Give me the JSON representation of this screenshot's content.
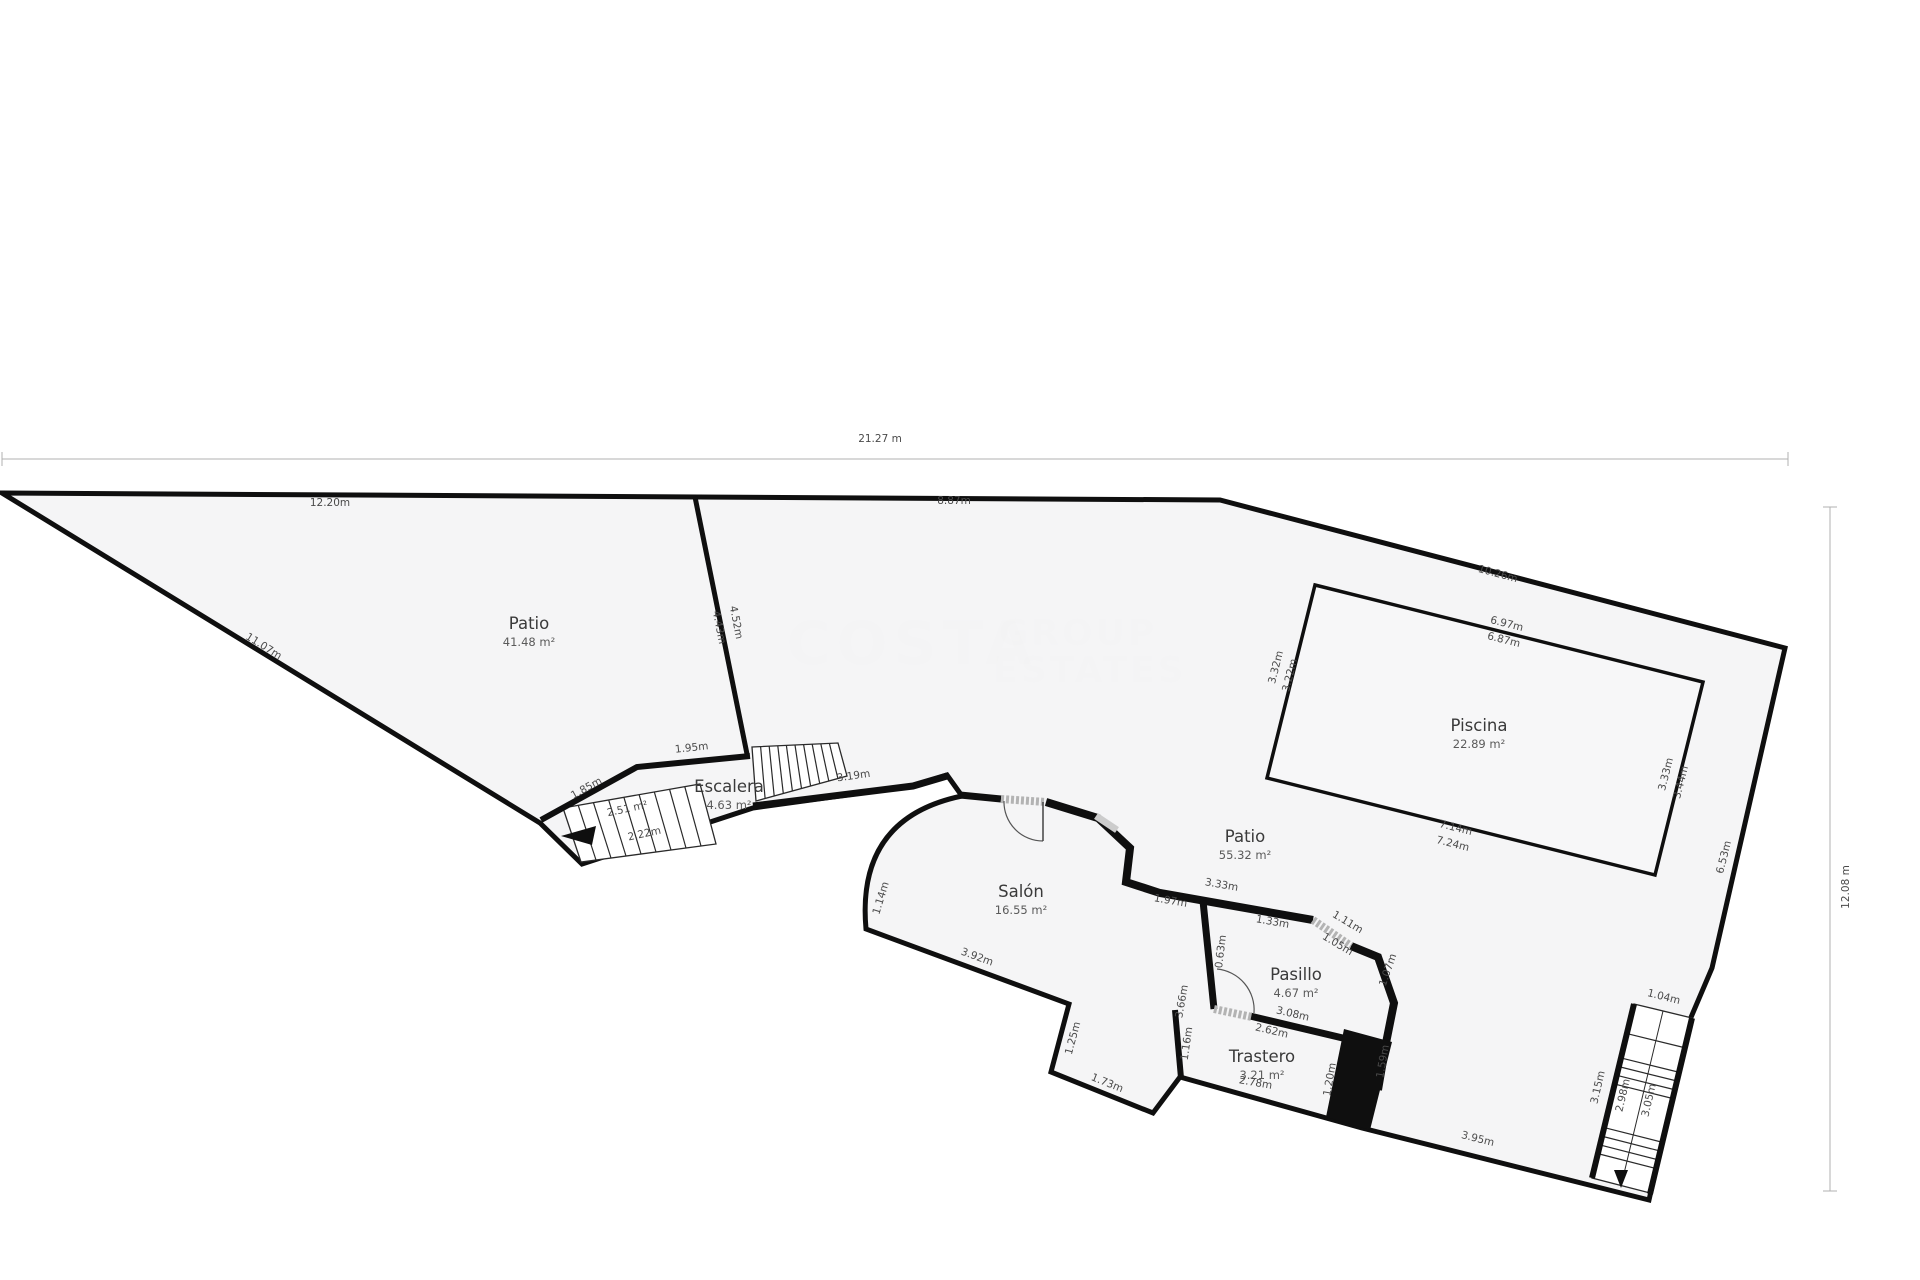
{
  "title": "Plano de planta",
  "colors": {
    "plot_fill": "#f4f4f5",
    "pool_fill": "#f7f7f8",
    "wall": "#0f0f0f",
    "thin": "#2a2a2a",
    "dim_line": "#b0b0b0",
    "dim_text": "#4a4a4a",
    "room_text": "#3a3a3a",
    "door": "#b3b3b3"
  },
  "plan": {
    "outline": "M 2,493 L 1220,500 L 1785,648 L 1712,968 L 1689,1022 L 1649,1200 L 1362,1128 L 1180,1077 L 1153,1113 L 1051,1072 L 1069,1004 L 866,929 Q 856,818 962,796 L 947,775 L 913,786 L 753,808 L 582,864 L 540,823 Z",
    "pool": "M 1315,585 L 1703,682 L 1655,875 L 1267,778 Z",
    "block": "M 1344,1029 L 1392,1042 L 1370,1130 L 1326,1117 Z",
    "walls": [
      {
        "d": "M 695,497 L 747,754",
        "w": 5
      },
      {
        "d": "M 541,820 L 637,767 L 750,756",
        "w": 6
      },
      {
        "d": "M 753,806 L 913,786 L 947,776",
        "w": 7
      },
      {
        "d": "M 960,795 L 1001,799",
        "w": 7
      },
      {
        "d": "M 1046,802 L 1098,818 L 1130,848 L 1126,882 L 1160,893 L 1313,920",
        "w": 8
      },
      {
        "d": "M 1351,946 L 1378,957 L 1394,1003 L 1386,1043 L 1378,1090",
        "w": 8
      },
      {
        "d": "M 1203,901 L 1214,1009",
        "w": 7
      },
      {
        "d": "M 1250,1016 L 1368,1044",
        "w": 7
      },
      {
        "d": "M 1175,1010 L 1181,1078",
        "w": 6
      },
      {
        "d": "M 1634,1004 L 1592,1178",
        "w": 6
      },
      {
        "d": "M 1692,1018 L 1650,1194",
        "w": 6
      }
    ],
    "windows": [
      {
        "d": "M 1096,816 L 1117,830",
        "w": 7
      }
    ],
    "doors": [
      {
        "leaf": "M 1001,799 L 1046,802",
        "arc": "M 1004,801 A 39,39 0 0 0 1043,841",
        "pivot": "M 1043,802 L 1043,841"
      },
      {
        "leaf": "M 1313,920 L 1351,946",
        "arc": "",
        "pivot": ""
      },
      {
        "leaf": "M 1214,1009 L 1252,1017",
        "arc": "M 1217,969 A 41,41 0 0 1 1254,1013",
        "pivot": ""
      }
    ],
    "stairs": [
      {
        "corners": [
          [
            563,
            808
          ],
          [
            700,
            784
          ],
          [
            716,
            844
          ],
          [
            581,
            862
          ]
        ],
        "treads": 8,
        "dir": "h",
        "axis": false
      },
      {
        "corners": [
          [
            752,
            747
          ],
          [
            838,
            743
          ],
          [
            847,
            776
          ],
          [
            756,
            801
          ]
        ],
        "treads": 9,
        "dir": "h",
        "axis": false
      },
      {
        "corners": [
          [
            1634,
            1004
          ],
          [
            1692,
            1018
          ],
          [
            1650,
            1193
          ],
          [
            1592,
            1178
          ]
        ],
        "treads": [
          0.17,
          0.31,
          0.36,
          0.41,
          0.46,
          0.71,
          0.76,
          0.81,
          0.86
        ],
        "dir": "v",
        "axis": true
      }
    ],
    "axis_line": "M 1663,1011 L 1621,1186",
    "arrows": [
      [
        [
          561,
          836
        ],
        [
          596,
          826
        ],
        [
          592,
          845
        ]
      ],
      [
        [
          1614,
          1170
        ],
        [
          1628,
          1170
        ],
        [
          1621,
          1188
        ]
      ]
    ],
    "dim_lines": [
      {
        "d": "M 2,459 L 1788,459"
      },
      {
        "d": "M 2,452 L 2,466"
      },
      {
        "d": "M 1788,452 L 1788,466"
      },
      {
        "d": "M 1830,507 L 1830,1191"
      },
      {
        "d": "M 1823,507 L 1837,507"
      },
      {
        "d": "M 1823,1191 L 1837,1191"
      }
    ],
    "rooms": [
      {
        "name": "Patio",
        "area": "41.48 m²",
        "x": 529,
        "y": 629
      },
      {
        "name": "Patio",
        "area": "55.32 m²",
        "x": 1245,
        "y": 842
      },
      {
        "name": "Piscina",
        "area": "22.89 m²",
        "x": 1479,
        "y": 731
      },
      {
        "name": "Salón",
        "area": "16.55 m²",
        "x": 1021,
        "y": 897
      },
      {
        "name": "Pasillo",
        "area": "4.67 m²",
        "x": 1296,
        "y": 980
      },
      {
        "name": "Trastero",
        "area": "3.21 m²",
        "x": 1262,
        "y": 1062
      },
      {
        "name": "Escalera",
        "area": "4.63 m²",
        "x": 729,
        "y": 792
      }
    ],
    "dims": [
      {
        "t": "21.27 m",
        "x": 880,
        "y": 442,
        "r": 0
      },
      {
        "t": "12.08 m",
        "x": 1849,
        "y": 887,
        "r": -90
      },
      {
        "t": "12.20m",
        "x": 330,
        "y": 506,
        "r": 0
      },
      {
        "t": "8.87m",
        "x": 954,
        "y": 504,
        "r": 0
      },
      {
        "t": "11.07m",
        "x": 262,
        "y": 649,
        "r": 32
      },
      {
        "t": "10.26m",
        "x": 1497,
        "y": 577,
        "r": 15
      },
      {
        "t": "6.97m",
        "x": 1506,
        "y": 627,
        "r": 14
      },
      {
        "t": "6.87m",
        "x": 1503,
        "y": 643,
        "r": 14
      },
      {
        "t": "3.32m",
        "x": 1279,
        "y": 668,
        "r": -76
      },
      {
        "t": "3.22m",
        "x": 1293,
        "y": 676,
        "r": -76
      },
      {
        "t": "7.14m",
        "x": 1455,
        "y": 831,
        "r": 14
      },
      {
        "t": "7.24m",
        "x": 1452,
        "y": 847,
        "r": 14
      },
      {
        "t": "3.33m",
        "x": 1669,
        "y": 775,
        "r": -76
      },
      {
        "t": "3.44m",
        "x": 1684,
        "y": 783,
        "r": -76
      },
      {
        "t": "6.53m",
        "x": 1727,
        "y": 858,
        "r": -76
      },
      {
        "t": "4.52m",
        "x": 733,
        "y": 623,
        "r": 79
      },
      {
        "t": "4.43m",
        "x": 716,
        "y": 628,
        "r": 79
      },
      {
        "t": "1.95m",
        "x": 692,
        "y": 751,
        "r": -6
      },
      {
        "t": "1.85m",
        "x": 588,
        "y": 791,
        "r": -29
      },
      {
        "t": "3.19m",
        "x": 854,
        "y": 779,
        "r": -8
      },
      {
        "t": "2.51 m²",
        "x": 628,
        "y": 812,
        "r": -12
      },
      {
        "t": "2.22m",
        "x": 645,
        "y": 837,
        "r": -12
      },
      {
        "t": "1.14m",
        "x": 884,
        "y": 899,
        "r": -73
      },
      {
        "t": "3.92m",
        "x": 976,
        "y": 960,
        "r": 20
      },
      {
        "t": "1.25m",
        "x": 1076,
        "y": 1039,
        "r": -75
      },
      {
        "t": "1.73m",
        "x": 1106,
        "y": 1086,
        "r": 22
      },
      {
        "t": "1.16m",
        "x": 1190,
        "y": 1044,
        "r": -82
      },
      {
        "t": "3.66m",
        "x": 1185,
        "y": 1002,
        "r": -80
      },
      {
        "t": "0.63m",
        "x": 1224,
        "y": 952,
        "r": -83
      },
      {
        "t": "1.97m",
        "x": 1170,
        "y": 904,
        "r": 10
      },
      {
        "t": "3.33m",
        "x": 1221,
        "y": 888,
        "r": 10
      },
      {
        "t": "1.33m",
        "x": 1272,
        "y": 925,
        "r": 10
      },
      {
        "t": "1.11m",
        "x": 1346,
        "y": 925,
        "r": 31
      },
      {
        "t": "1.05m",
        "x": 1336,
        "y": 947,
        "r": 31
      },
      {
        "t": "1.07m",
        "x": 1391,
        "y": 971,
        "r": -71
      },
      {
        "t": "1.59m",
        "x": 1386,
        "y": 1062,
        "r": -80
      },
      {
        "t": "3.08m",
        "x": 1292,
        "y": 1017,
        "r": 13
      },
      {
        "t": "2.62m",
        "x": 1271,
        "y": 1034,
        "r": 13
      },
      {
        "t": "2.78m",
        "x": 1255,
        "y": 1086,
        "r": 10
      },
      {
        "t": "1.20m",
        "x": 1333,
        "y": 1080,
        "r": -80
      },
      {
        "t": "3.95m",
        "x": 1477,
        "y": 1142,
        "r": 14
      },
      {
        "t": "1.04m",
        "x": 1663,
        "y": 1000,
        "r": 14
      },
      {
        "t": "3.15m",
        "x": 1601,
        "y": 1088,
        "r": -77
      },
      {
        "t": "2.98m",
        "x": 1626,
        "y": 1096,
        "r": -77
      },
      {
        "t": "3.05m",
        "x": 1652,
        "y": 1101,
        "r": -77
      }
    ],
    "watermark": [
      {
        "t": "COSTA",
        "x": 912,
        "y": 664,
        "s": 60,
        "sp": 6
      },
      {
        "t": "GROUP",
        "x": 1078,
        "y": 645,
        "s": 36,
        "sp": 3
      },
      {
        "t": "ESTATES",
        "x": 1090,
        "y": 682,
        "s": 36,
        "sp": 3
      }
    ]
  }
}
